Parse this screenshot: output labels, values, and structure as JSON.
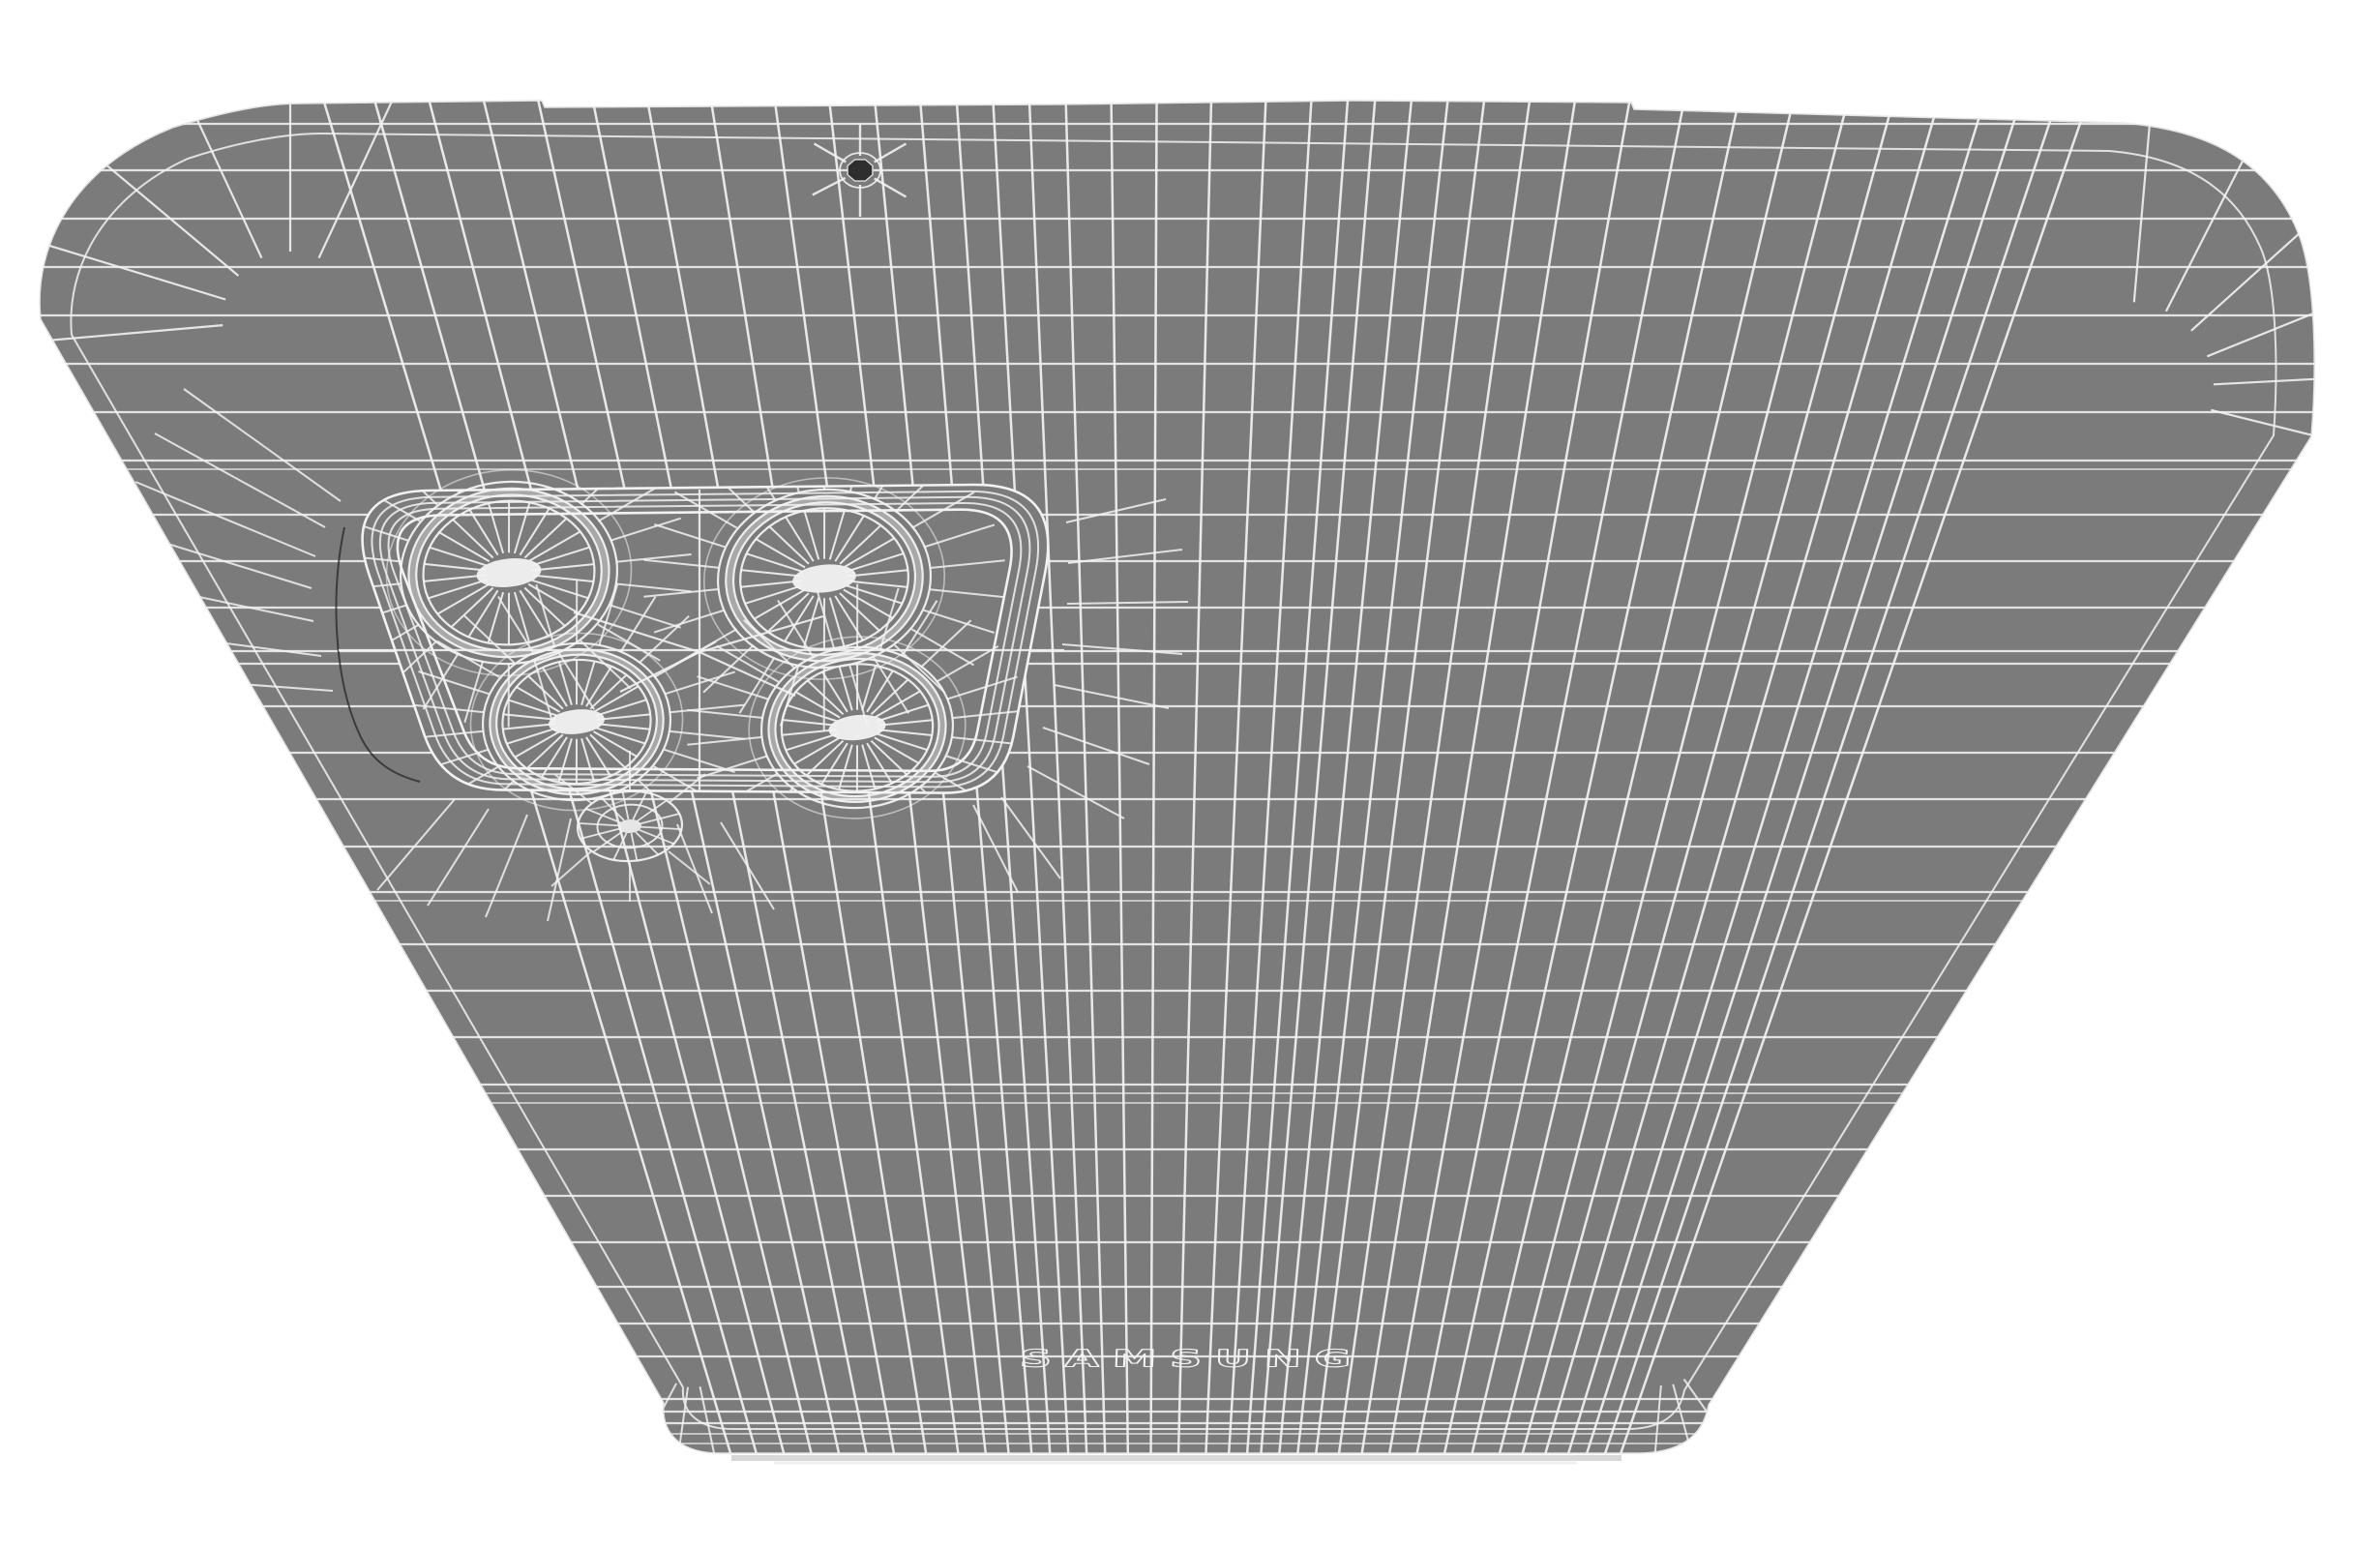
{
  "scene": {
    "description": "3D wireframe render of a smartphone back panel in perspective",
    "brand": {
      "label": "SAMSUNG"
    },
    "object": {
      "type": "smartphone-back-wireframe",
      "lens_count": 4,
      "flash_count": 1,
      "mic_hole_count": 1
    },
    "colors": {
      "background": "#ffffff",
      "body": "#7b7b7b",
      "wireframe": "#f2f2f2",
      "crease": "#262626",
      "mic_hole": "#2e2e2e",
      "lens_center": "#f2f2f2",
      "bottom_edge_light": "#d6d6d6"
    }
  }
}
